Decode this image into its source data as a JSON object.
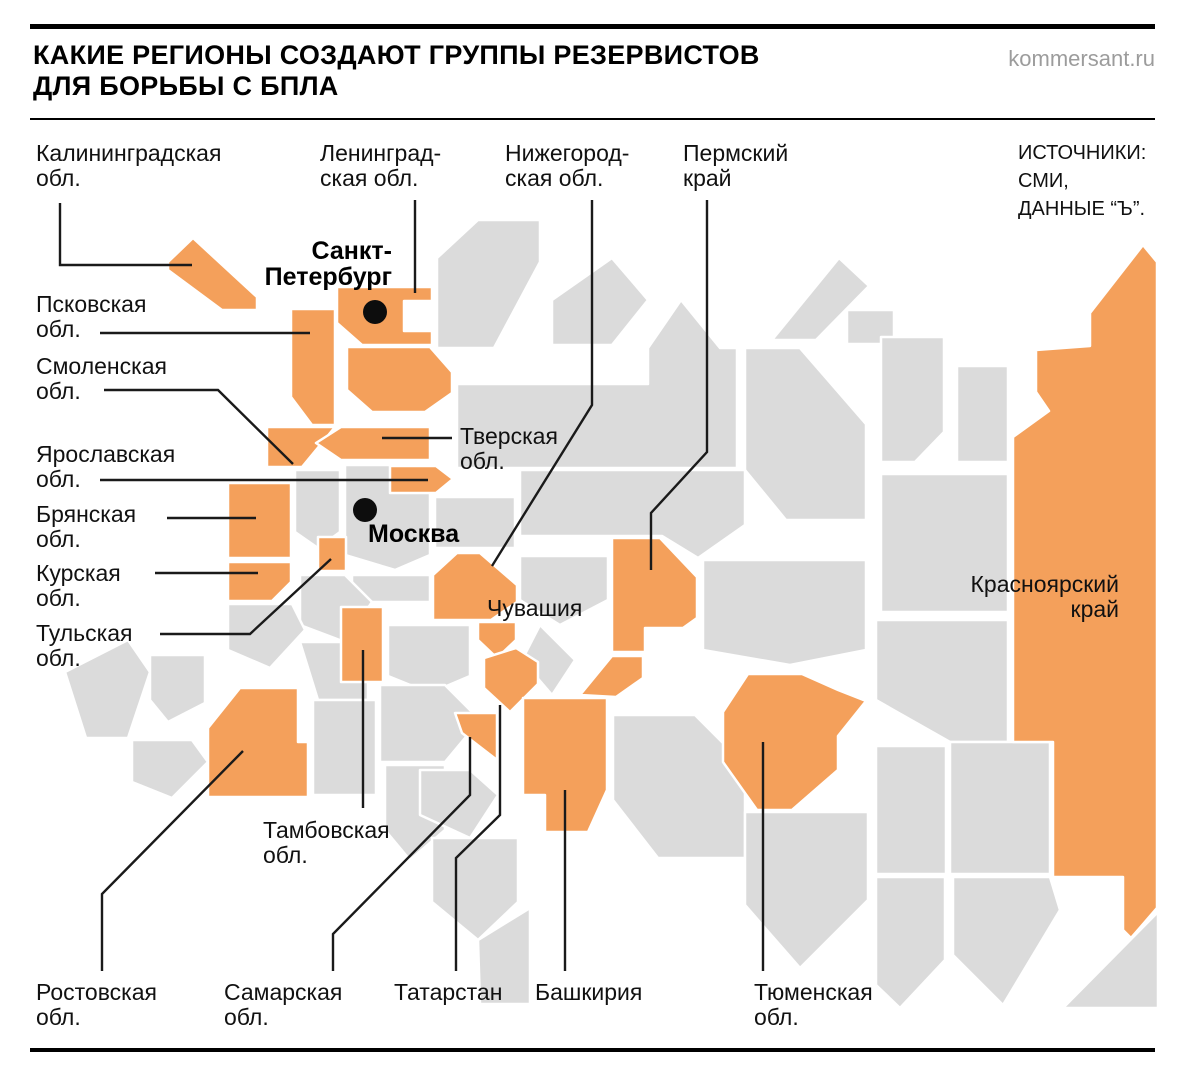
{
  "header": {
    "title": "КАКИЕ РЕГИОНЫ СОЗДАЮТ ГРУППЫ РЕЗЕРВИСТОВ\nДЛЯ БОРЬБЫ С БПЛА",
    "site": "kommersant.ru"
  },
  "sources": {
    "text": "ИСТОЧНИКИ:\nСМИ,\nДАННЫЕ “Ъ”."
  },
  "cities": {
    "spb": "Санкт-\nПетербург",
    "moscow": "Москва"
  },
  "labels": {
    "kaliningrad": "Калининградская\nобл.",
    "leningrad": "Ленинград-\nская обл.",
    "nizhny_novgorod": "Нижегород-\nская обл.",
    "perm": "Пермский\nкрай",
    "pskov": "Псковская\nобл.",
    "smolensk": "Смоленская\nобл.",
    "tver": "Тверская\nобл.",
    "yaroslavl": "Ярославская\nобл.",
    "bryansk": "Брянская\nобл.",
    "kursk": "Курская\nобл.",
    "chuvashia": "Чувашия",
    "tula": "Тульская\nобл.",
    "krasnoyarsk": "Красноярский\nкрай",
    "tambov": "Тамбовская\nобл.",
    "rostov": "Ростовская\nобл.",
    "samara": "Самарская\nобл.",
    "tatarstan": "Татарстан",
    "bashkiria": "Башкирия",
    "tyumen": "Тюменская\nобл."
  },
  "colors": {
    "highlight": "#f4a05b",
    "region_base": "#dbdbdb",
    "region_outline": "#ffffff",
    "leader_line": "#1a1a1a",
    "text": "#111111",
    "muted_text": "#9c9c9c"
  }
}
